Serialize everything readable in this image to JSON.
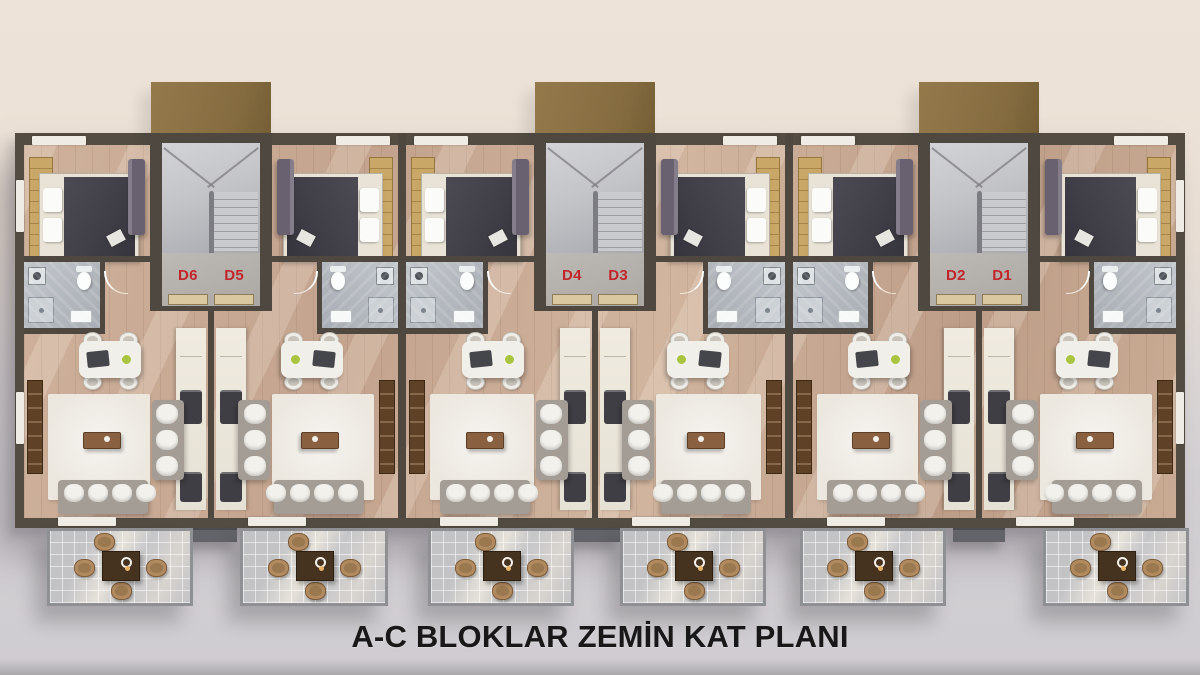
{
  "title": "A-C BLOKLAR ZEMİN KAT PLANI",
  "plan_type": "floor-plan",
  "stair_halls": [
    {
      "left_label": "D6",
      "right_label": "D5"
    },
    {
      "left_label": "D4",
      "right_label": "D3"
    },
    {
      "left_label": "D2",
      "right_label": "D1"
    }
  ],
  "units": [
    {
      "id": "D6"
    },
    {
      "id": "D5"
    },
    {
      "id": "D4"
    },
    {
      "id": "D3"
    },
    {
      "id": "D2"
    },
    {
      "id": "D1"
    }
  ],
  "colors": {
    "label_red": "#c2262b",
    "title_text": "#181818",
    "canopy_brown": "#8a7044",
    "wall_dark": "#4e4840",
    "wood_floor": "#c5a68f",
    "wood_accent": "#c9a766",
    "bath_tile": "#b8bdc3",
    "stair_floor": "#c3c4c8",
    "hall_floor": "#b3afab",
    "terrace_tile": "#c6c6c9",
    "rug_cream": "#ece8e0",
    "sofa_gray": "#a39d95",
    "bed_duvet": "#45444c",
    "kitchen_counter": "#ece7dc",
    "tv_console": "#5e4126",
    "lounge_purple": "#696070",
    "terrace_table": "#46331f",
    "terrace_chair": "#b18a5f",
    "background_top": "#ece2d7",
    "background_bottom": "#cfccd1"
  }
}
